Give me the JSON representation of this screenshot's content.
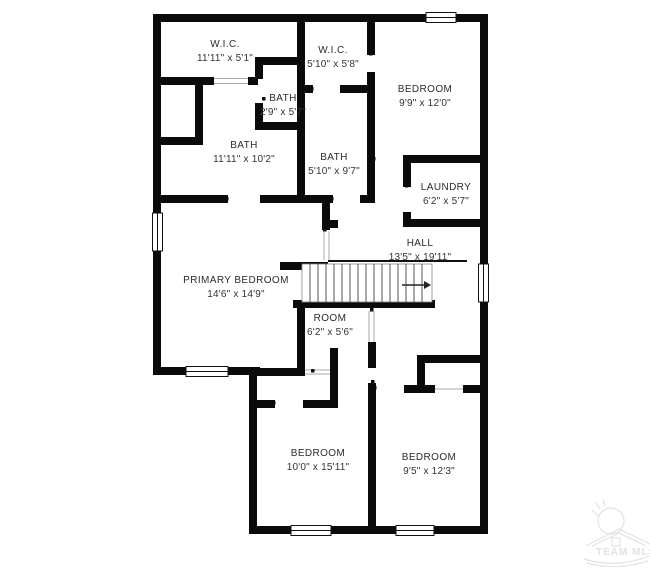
{
  "plan": {
    "wall_color": "#0b0b0b",
    "rooms": [
      {
        "name": "W.I.C.",
        "dims": "11'11\" x 5'1\""
      },
      {
        "name": "W.I.C.",
        "dims": "5'10\" x 5'8\""
      },
      {
        "name": "BEDROOM",
        "dims": "9'9\" x 12'0\""
      },
      {
        "name": "BATH",
        "dims": "2'9\" x 5'7\""
      },
      {
        "name": "BATH",
        "dims": "11'11\" x 10'2\""
      },
      {
        "name": "BATH",
        "dims": "5'10\" x 9'7\""
      },
      {
        "name": "LAUNDRY",
        "dims": "6'2\" x 5'7\""
      },
      {
        "name": "HALL",
        "dims": "13'5\" x 19'11\""
      },
      {
        "name": "PRIMARY BEDROOM",
        "dims": "14'6\" x 14'9\""
      },
      {
        "name": "ROOM",
        "dims": "6'2\" x 5'6\""
      },
      {
        "name": "BEDROOM",
        "dims": "10'0\" x 15'11\""
      },
      {
        "name": "BEDROOM",
        "dims": "9'5\" x 12'3\""
      }
    ],
    "watermark": {
      "text": "TEAM MLS",
      "color": "#e2e2e2"
    }
  }
}
